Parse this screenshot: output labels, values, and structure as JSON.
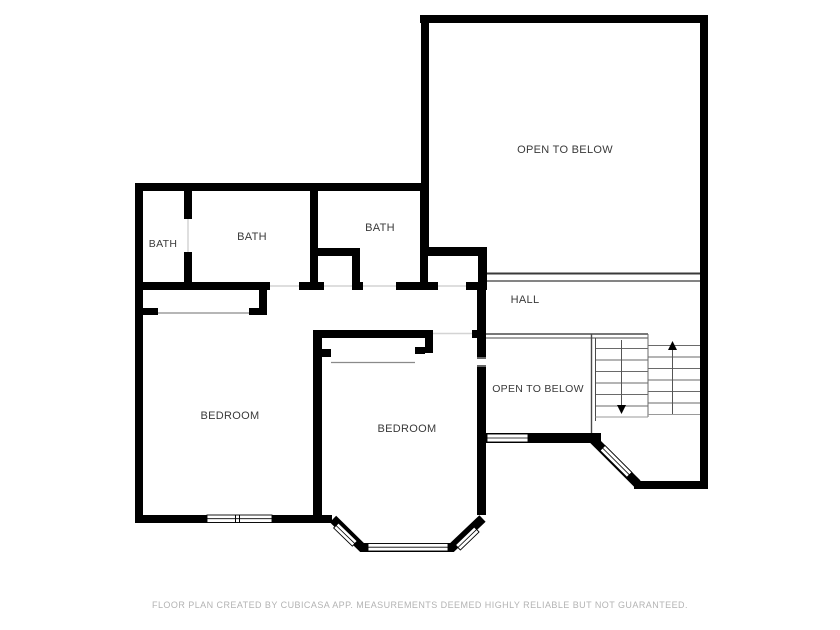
{
  "rooms": {
    "bath_small": {
      "label": "BATH"
    },
    "bath_main": {
      "label": "BATH"
    },
    "bath_hall": {
      "label": "BATH"
    },
    "hall": {
      "label": "HALL"
    },
    "open_to_below_large": {
      "label": "OPEN TO BELOW"
    },
    "open_to_below_small": {
      "label": "OPEN TO BELOW"
    },
    "bedroom_left": {
      "label": "BEDROOM"
    },
    "bedroom_right": {
      "label": "BEDROOM"
    }
  },
  "stairs": {
    "up_direction_icon": "up-arrow",
    "down_direction_icon": "down-arrow"
  },
  "footer": {
    "disclaimer": "FLOOR PLAN CREATED BY CUBICASA APP. MEASUREMENTS DEEMED HIGHLY RELIABLE BUT NOT GUARANTEED."
  },
  "colors": {
    "background": "#ffffff",
    "wall": "#000000",
    "label_text": "#3a3a3a",
    "footer_text": "#b3b3b3",
    "stair_line": "#5a5a5a",
    "railing_line": "#3a3a3a",
    "threshold_line": "#d0d0d0",
    "closet_line": "#8a8a8a"
  }
}
